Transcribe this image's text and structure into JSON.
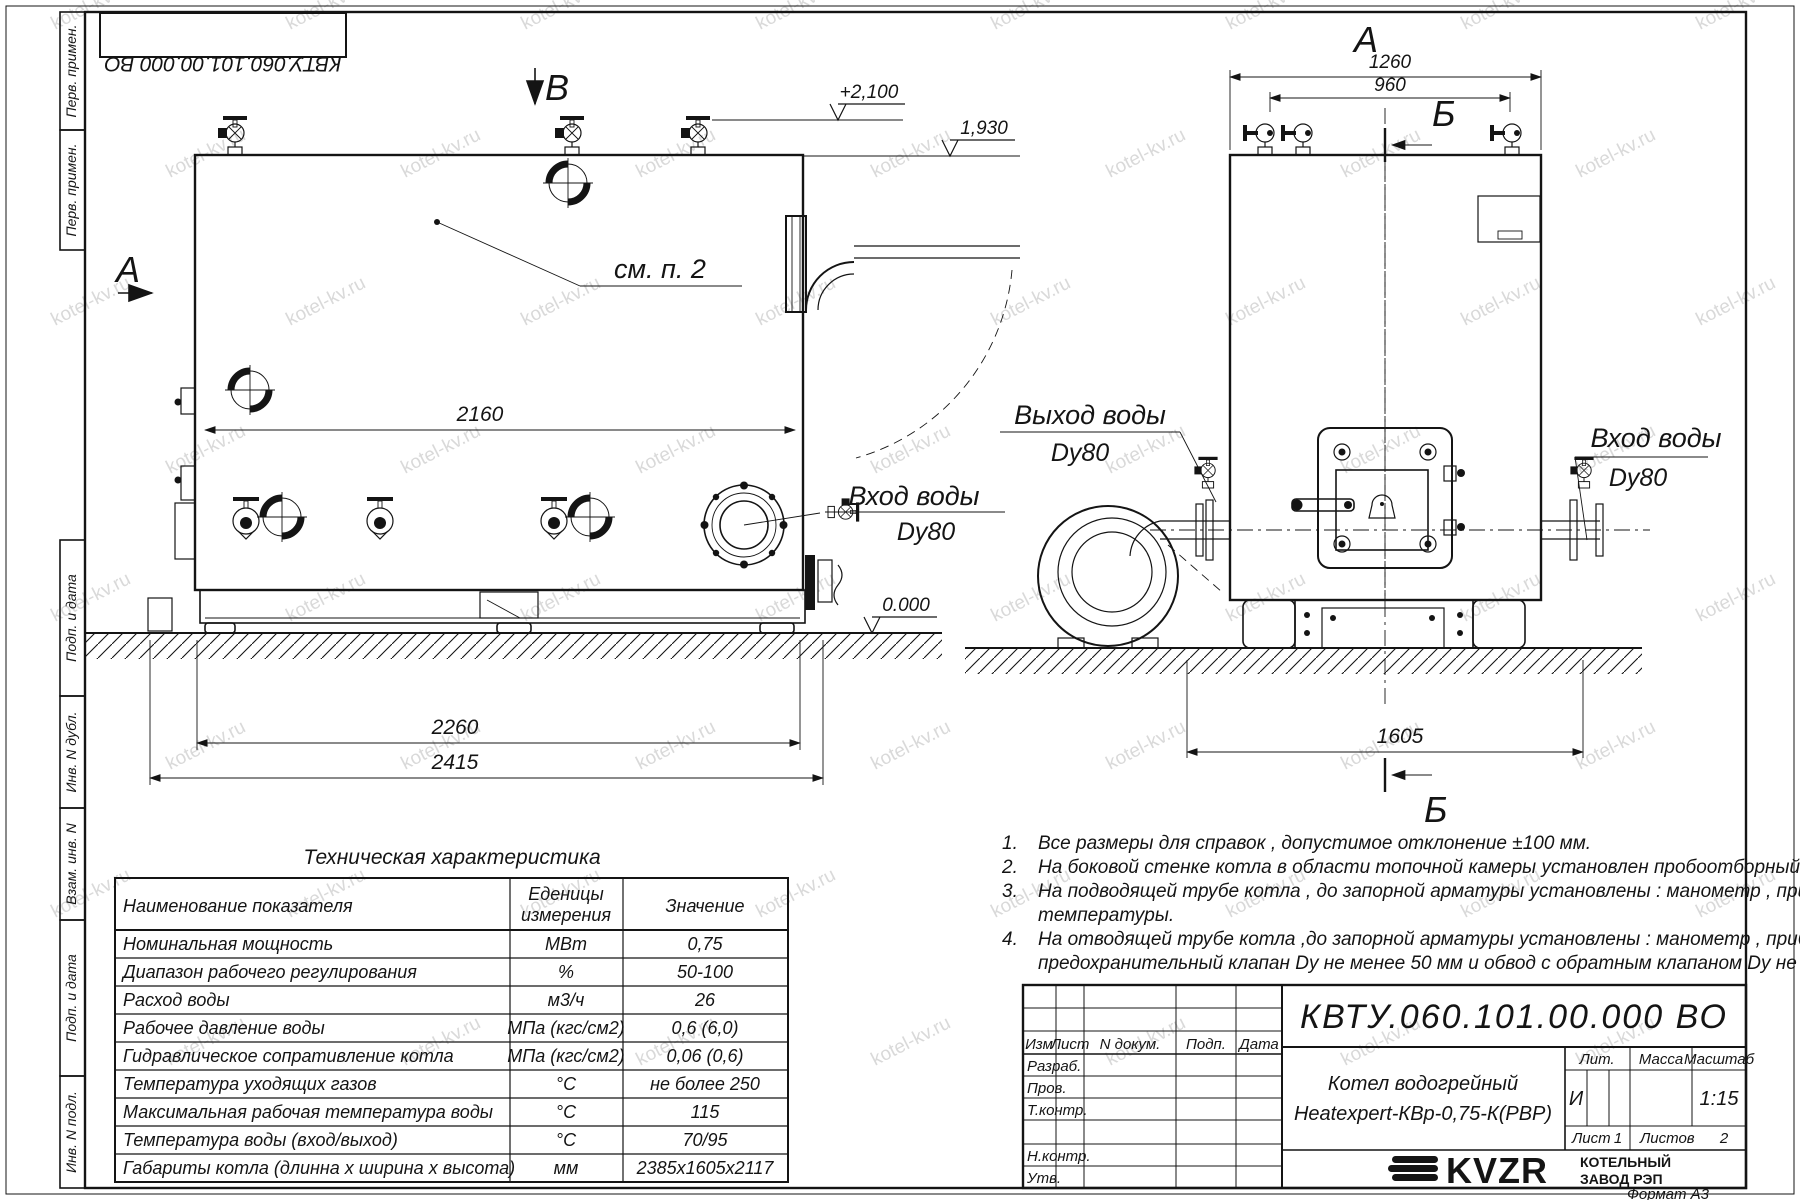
{
  "document": {
    "number": "КВТУ.060.101.00.000  ВО",
    "format_label": "Формат   А3",
    "product_line1": "Котел водогрейный",
    "product_line2": "Heatexpert-КВр-0,75-К(РВР)",
    "litera_header": "Лит.",
    "mass_header": "Масса",
    "scale_header": "Масштаб",
    "litera": "И",
    "scale": "1:15",
    "sheet_label": "Лист",
    "sheet": "1",
    "sheets_label": "Листов",
    "sheets": "2"
  },
  "company": {
    "logo": "KVZR",
    "name_line1": "КОТЕЛЬНЫЙ",
    "name_line2": "ЗАВОД РЭП"
  },
  "stamp": {
    "header_cells": [
      "Изм",
      "Лист",
      "N докум.",
      "Подп.",
      "Дата"
    ],
    "left_rows": [
      "Разраб.",
      "Пров.",
      "Т.контр.",
      "Н.контр.",
      "Утв."
    ]
  },
  "side_strip": {
    "top": [
      "Перв. примен.",
      "Перв. примен."
    ],
    "bottom": [
      "Подп. и дата",
      "Инв. N дубл.",
      "Взам. инв. N",
      "Подп. и дата",
      "Инв. N подл."
    ]
  },
  "views": {
    "side": {
      "marker_top": "В",
      "marker_left": "А",
      "see_note": "см. п. 2",
      "dim_width": "2160",
      "dim_base": "2260",
      "dim_overall": "2415",
      "elev_top": "+2,100",
      "elev_mid": "1,930",
      "elev_zero": "0.000",
      "inlet_line1": "Вход воды",
      "inlet_line2": "Dy80"
    },
    "front": {
      "marker_top": "А",
      "section_letter_top": "Б",
      "section_letter_bottom": "Б",
      "dim_top": "1260",
      "dim_inner": "960",
      "dim_bottom": "1605",
      "outlet_line1": "Выход воды",
      "outlet_line2": "Dy80",
      "inlet_line1": "Вход воды",
      "inlet_line2": "Dy80"
    }
  },
  "table": {
    "title": "Техническая характеристика",
    "header_name": "Наименование показателя",
    "header_units_1": "Еденицы",
    "header_units_2": "измерения",
    "header_value": "Значение",
    "rows": [
      {
        "name": "Номинальная мощность",
        "units": "МВт",
        "value": "0,75"
      },
      {
        "name": "Диапазон рабочего регулирования",
        "units": "%",
        "value": "50-100"
      },
      {
        "name": "Расход воды",
        "units": "м3/ч",
        "value": "26"
      },
      {
        "name": "Рабочее давление воды",
        "units": "МПа (кгс/см2)",
        "value": "0,6 (6,0)"
      },
      {
        "name": "Гидравлическое сопративление котла",
        "units": "МПа (кгс/см2)",
        "value": "0,06 (0,6)"
      },
      {
        "name": "Температура уходящих газов",
        "units": "°С",
        "value": "не более 250"
      },
      {
        "name": "Максимальная рабочая температура воды",
        "units": "°С",
        "value": "115"
      },
      {
        "name": "Температура воды (вход/выход)",
        "units": "°С",
        "value": "70/95"
      },
      {
        "name": "Габариты котла (длинна х ширина х высота)",
        "units": "мм",
        "value": "2385х1605х2117"
      }
    ]
  },
  "notes": [
    {
      "num": "1.",
      "lines": [
        "Все размеры для справок , допустимое отклонение  ±100 мм."
      ]
    },
    {
      "num": "2.",
      "lines": [
        "На боковой стенке котла в области топочной камеры установлен пробоотборный штуцер"
      ]
    },
    {
      "num": "3.",
      "lines": [
        "На   подводящей трубе котла , до запорной арматуры установлены : манометр , прибор для измерения",
        "температуры."
      ]
    },
    {
      "num": "4.",
      "lines": [
        "На отводящей трубе котла ,до запорной арматуры установлены : манометр , прибор для измерения температуры ,",
        "предохранительный клапан  Dу не менее  50 мм и обвод с обратным клапаном  Dу не менее  50 мм."
      ]
    }
  ],
  "watermark": {
    "text": "kotel-kv.ru",
    "color": "#c0c0c0"
  }
}
